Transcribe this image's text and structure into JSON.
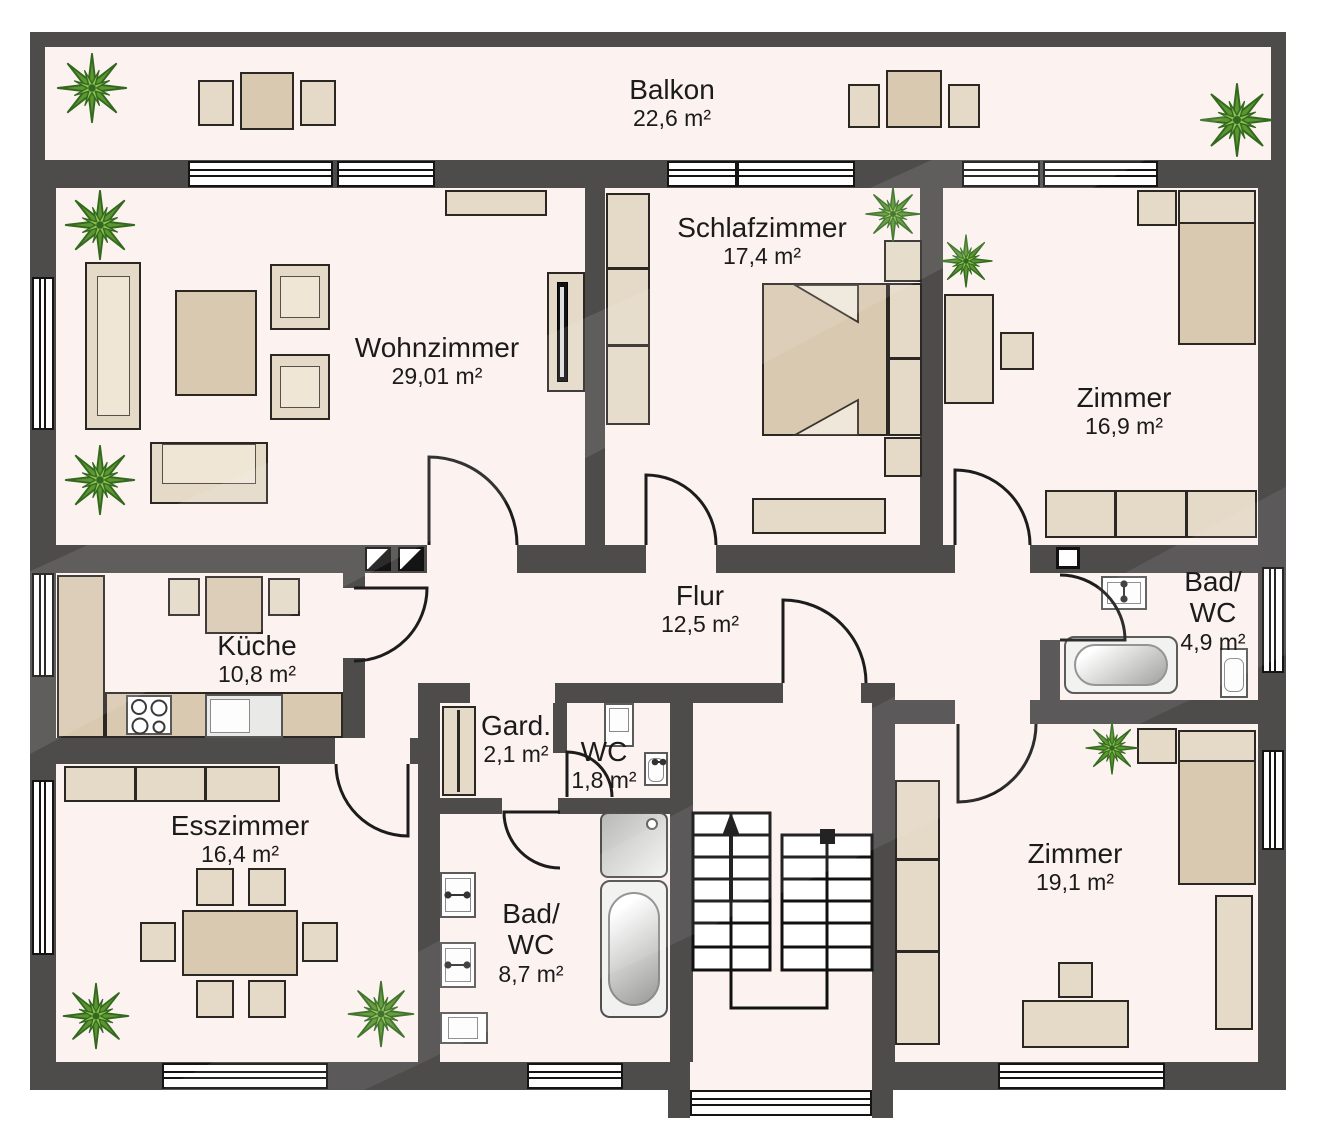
{
  "plan": {
    "type": "floor-plan",
    "rooms": [
      {
        "id": "balkon",
        "name": "Balkon",
        "area": "22,6 m²"
      },
      {
        "id": "wohnzimmer",
        "name": "Wohnzimmer",
        "area": "29,01 m²"
      },
      {
        "id": "schlafzimmer",
        "name": "Schlafzimmer",
        "area": "17,4 m²"
      },
      {
        "id": "zimmer-oben",
        "name": "Zimmer",
        "area": "16,9 m²"
      },
      {
        "id": "kueche",
        "name": "Küche",
        "area": "10,8 m²"
      },
      {
        "id": "flur",
        "name": "Flur",
        "area": "12,5 m²"
      },
      {
        "id": "bad-wc-klein",
        "name": "Bad/\nWC",
        "area": "4,9 m²"
      },
      {
        "id": "garderobe",
        "name": "Gard.",
        "area": "2,1 m²"
      },
      {
        "id": "wc",
        "name": "WC",
        "area": "1,8 m²"
      },
      {
        "id": "esszimmer",
        "name": "Esszimmer",
        "area": "16,4 m²"
      },
      {
        "id": "bad-wc-gross",
        "name": "Bad/\nWC",
        "area": "8,7 m²"
      },
      {
        "id": "zimmer-unten",
        "name": "Zimmer",
        "area": "19,1 m²"
      }
    ],
    "colors": {
      "wall": "#4e4b4b",
      "floor": "#fcf2ef",
      "furniture": "#e5dac7",
      "furniture_dark": "#d9c9b0",
      "outline": "#2b2824",
      "fixture": "#ffffff",
      "fixture_border": "#5a5a5a",
      "plant_green": "#5c9631",
      "plant_light": "#8cc152",
      "plant_dark": "#33691e",
      "stair_line": "#111111",
      "label_text": "#1b1b1b"
    }
  }
}
